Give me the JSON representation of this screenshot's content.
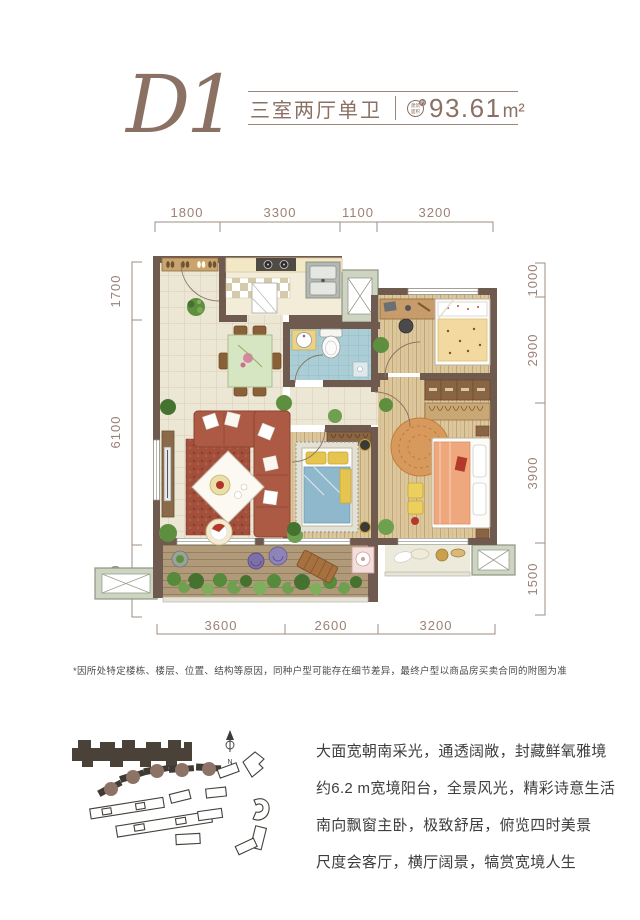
{
  "header": {
    "plan_code": "D1",
    "unit_type": "三室两厅单卫",
    "area_value": "93.61",
    "area_unit": "m²",
    "badge_line1": "建筑",
    "badge_line2": "面积",
    "badge_mark": "约"
  },
  "floor_plan": {
    "dimensions": {
      "top": [
        "1800",
        "3300",
        "1100",
        "3200"
      ],
      "bottom": [
        "3600",
        "2600",
        "3200"
      ],
      "left": [
        "1700",
        "6100",
        "1500"
      ],
      "right": [
        "1000",
        "2900",
        "3900",
        "1500"
      ]
    }
  },
  "disclaimer": "*因所处特定楼栋、楼层、位置、结构等原因，同种户型可能存在细节差异，最终户型以商品房买卖合同的附图为准",
  "site_plan": {
    "compass_label": "N"
  },
  "description": {
    "lines": [
      "大面宽朝南采光，通透阔敞，封藏鲜氧雅境",
      "约6.2 m宽境阳台，全景风光，精彩诗意生活",
      "南向飘窗主卧，极致舒居，俯览四时美景",
      "尺度会客厅，横厅阔景，犒赏宽境人生"
    ]
  },
  "colors": {
    "accent": "#8a7164",
    "dimension_text": "#9b8176",
    "wall": "#6f5a4f",
    "tile_floor": "#ece6d4",
    "wood_floor": "#dcc79c",
    "bath_floor": "#abced6",
    "balcony_green": "#5d8f3f",
    "sofa_red": "#ad5a44",
    "body_text": "#3d3d3d"
  }
}
